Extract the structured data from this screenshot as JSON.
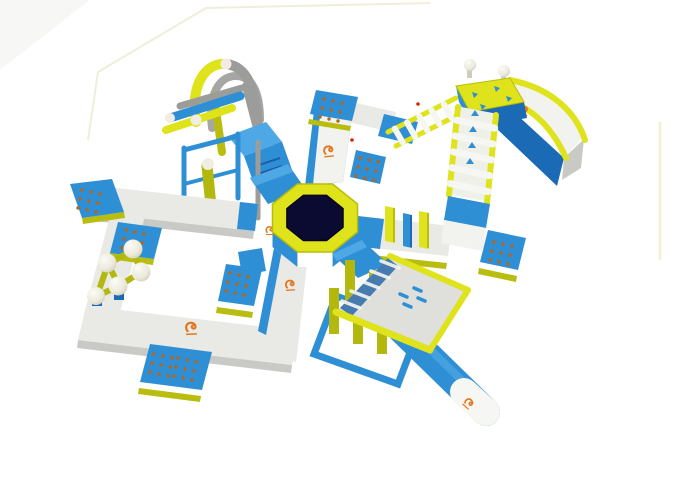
{
  "alt": "3D rendering of a modular inflatable floating water park obstacle course in blue, yellow and white on a plain white backdrop",
  "colors": {
    "background": "#ffffff",
    "blue": "#2e8fd4",
    "blue_light": "#4fa8e6",
    "blue_dark": "#1a6ab5",
    "blue_deep": "#0d4f93",
    "yellow": "#dfe31c",
    "yellow_dark": "#b9bd10",
    "olive": "#b3b80e",
    "walkway_top": "#e9e9e6",
    "walkway_side": "#f2f2ef",
    "walkway_shadow": "#c9c9c6",
    "navy": "#0b0b32",
    "orange": "#e4751c",
    "cream": "#f1eee1",
    "ball_shade": "#d6d2c2",
    "tube_gray": "#9c9c9a",
    "dot": "#b4661c",
    "frame_line": "#ecead0",
    "valve_red": "#d42a00"
  },
  "components": [
    {
      "id": "water-trampoline",
      "label": "Octagonal water trampoline with yellow ring and navy jump mat"
    },
    {
      "id": "slide-tower",
      "label": "Curved slide tower with climbing ladders"
    },
    {
      "id": "arch-obstacle",
      "label": "Tube arch climbing obstacle"
    },
    {
      "id": "swing-frame",
      "label": "Swing frame obstacle"
    },
    {
      "id": "hurdle-walkway",
      "label": "Balance hurdle walkway"
    },
    {
      "id": "canopy-obstacle",
      "label": "Pillared canopy obstacle"
    },
    {
      "id": "floating-log",
      "label": "Blue floating log beam with white tip"
    },
    {
      "id": "balance-balls",
      "label": "Ball and beam balance obstacle"
    },
    {
      "id": "walkway-loop",
      "label": "Floating walkway loop"
    },
    {
      "id": "boarding-ramps",
      "label": "Blue boarding ramps with grip dots"
    },
    {
      "id": "brand-logo",
      "label": "Orange brand logo mark"
    }
  ]
}
